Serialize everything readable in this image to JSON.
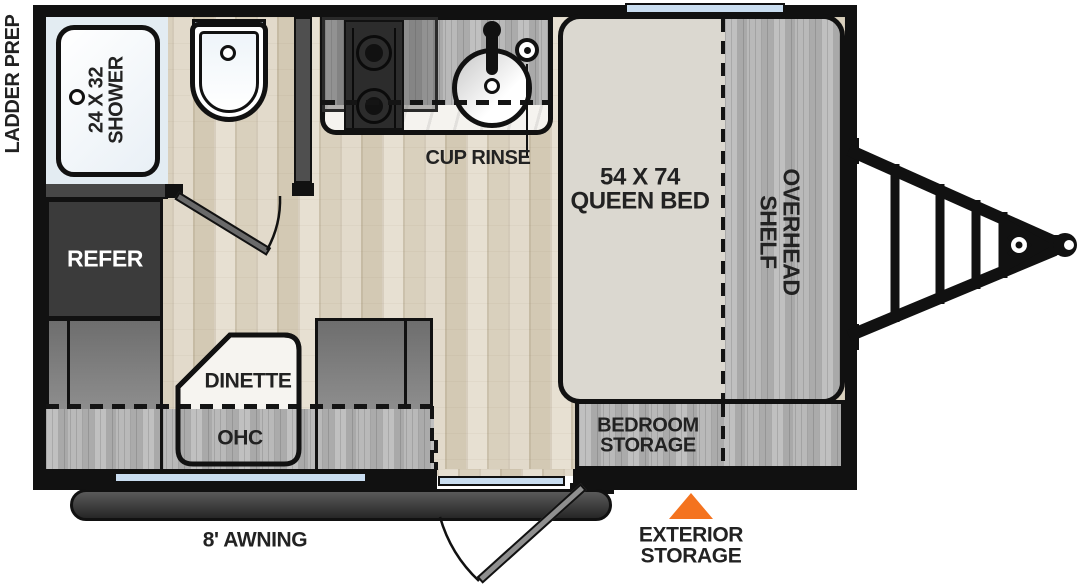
{
  "plan": {
    "title": "travel-trailer-floorplan",
    "side_label": "LADDER PREP",
    "shower": {
      "l1": "24 X 32",
      "l2": "SHOWER"
    },
    "cup_rinse": "CUP RINSE",
    "refer": "REFER",
    "dinette": "DINETTE",
    "ohc": "OHC",
    "bed": {
      "l1": "54 X 74",
      "l2": "QUEEN BED"
    },
    "overhead_shelf": {
      "l1": "OVERHEAD",
      "l2": "SHELF"
    },
    "bedroom_storage": {
      "l1": "BEDROOM",
      "l2": "STORAGE"
    },
    "awning": "8' AWNING",
    "exterior_storage": {
      "l1": "EXTERIOR",
      "l2": "STORAGE"
    },
    "colors": {
      "wall": "#111111",
      "window_blue": "#C9DDF0",
      "floor_wood": "#E2DACA",
      "cabinet_gray_wood": "#B3B3B3",
      "bed_fill": "#DBD8D0",
      "refrigerator": "#3B3B3B",
      "accent_orange": "#F4731F",
      "label_text": "#222222"
    }
  }
}
